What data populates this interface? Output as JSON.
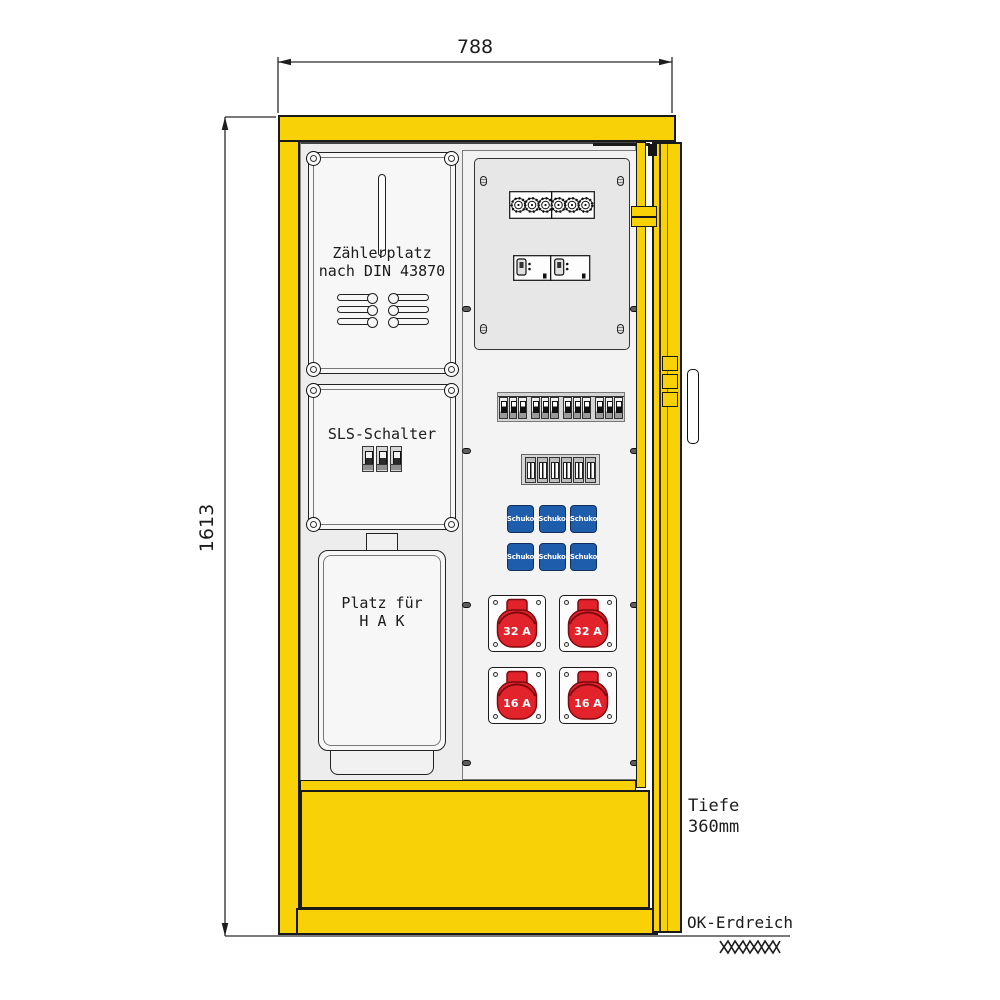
{
  "diagram": {
    "title_hint": "distribution-cabinet-technical-drawing",
    "dimensions": {
      "width_label": "788",
      "height_label": "1613"
    },
    "depth": {
      "line1": "Tiefe",
      "line2": "360mm"
    },
    "ground": {
      "label": "OK-Erdreich"
    },
    "panels": {
      "meter": {
        "line1": "Zählerplatz",
        "line2": "nach DIN 43870"
      },
      "sls": {
        "label": "SLS-Schalter"
      },
      "hak": {
        "line1": "Platz für",
        "line2": "H A K"
      }
    },
    "sockets": {
      "schuko_label": "Schuko",
      "cee": [
        {
          "label": "32 A"
        },
        {
          "label": "32 A"
        },
        {
          "label": "16 A"
        },
        {
          "label": "16 A"
        }
      ]
    },
    "colors": {
      "cabinet_yellow": "#F8D206",
      "schuko_blue": "#1E5DAC",
      "cee_red": "#E2232B",
      "outline": "#1A1A1A"
    }
  }
}
